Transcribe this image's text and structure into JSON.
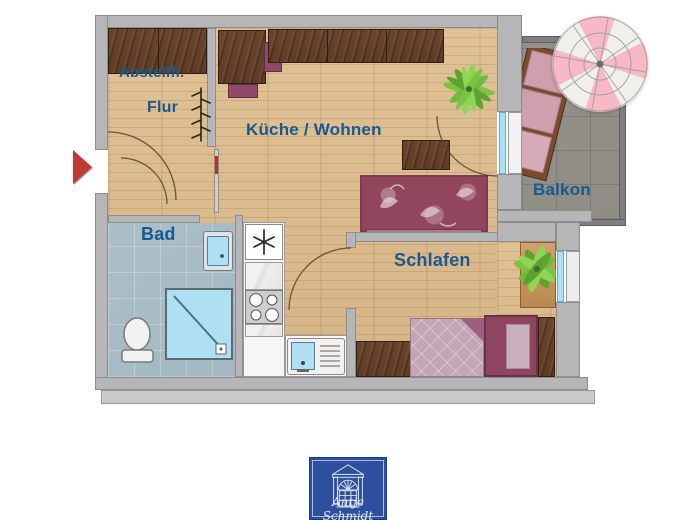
{
  "floorplan": {
    "labels": {
      "abstellfl": "Abstellfl.",
      "flur": "Flur",
      "kueche_wohnen": "Küche / Wohnen",
      "balkon": "Balkon",
      "bad": "Bad",
      "schlafen": "Schlafen"
    },
    "colors": {
      "label_text": "#19598f",
      "wall": "#b6b5b7",
      "wall_edge": "#8d8c8f",
      "wood_light": "#e0c296",
      "wood_dark": "#d6b587",
      "dark_wood": "#5f3b24",
      "bad_tile": "#a3b8c1",
      "balcony_tile": "#908d85",
      "fixture_blue": "#aee0f2",
      "sofa": "#91465e",
      "bed_frame": "#8e4560",
      "duvet": "#c3a6b4",
      "chair_purple": "#8e4a68",
      "cushion_pink": "#cf9fae",
      "plant_green": "#6fbc3c",
      "umbrella_pink": "#f6b9c5",
      "umbrella_white": "#f1efeb",
      "arrow_red": "#bf3a33",
      "logo_blue": "#2d4f9e"
    }
  },
  "footer": {
    "logo_text": "Antje Schmidt"
  }
}
